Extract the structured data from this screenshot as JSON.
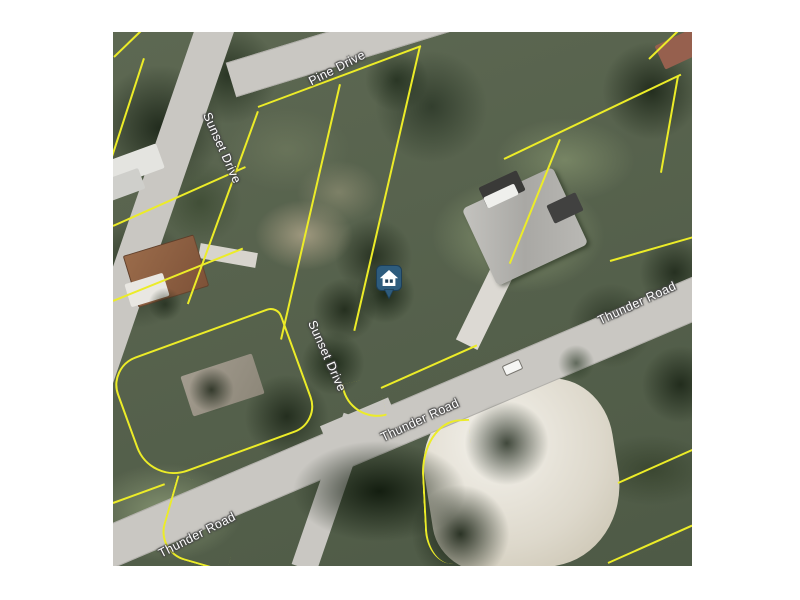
{
  "canvas": {
    "background_color": "#ffffff"
  },
  "map": {
    "type": "aerial-satellite-parcel-map",
    "parcel_line_color": "#ecec28",
    "road_color": "#c9c7c2",
    "labels": {
      "pine_drive": "Pine Drive",
      "sunset_drive_upper": "Sunset Drive",
      "sunset_drive_lower": "Sunset Drive",
      "thunder_road_right": "Thunder Road",
      "thunder_road_center": "Thunder Road",
      "thunder_road_bottom": "Thunder Road"
    },
    "marker": {
      "kind": "subject-property-home-marker",
      "pin_color": "#2e5c7d",
      "glyph": "house",
      "glyph_color": "#ffffff"
    }
  }
}
